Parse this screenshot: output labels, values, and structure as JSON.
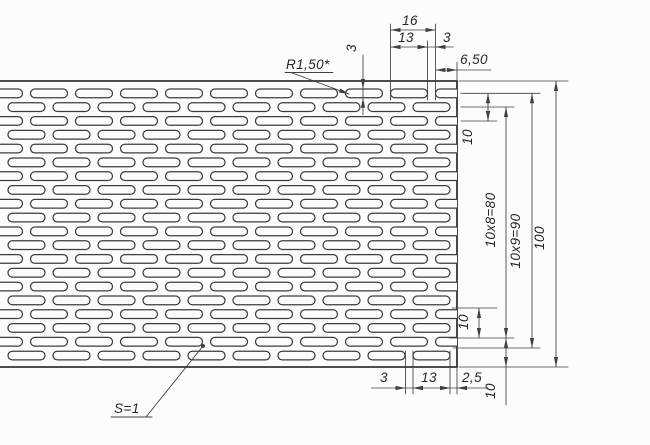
{
  "drawing": {
    "canvas": {
      "width": 650,
      "height": 445,
      "background": "#fcfcfc"
    },
    "colors": {
      "contour": "#343434",
      "slot": "#3d3d3d",
      "thin": "#404040",
      "text": "#262626"
    },
    "plate": {
      "top": 81,
      "bottom": 367,
      "right_edge": 457
    },
    "pattern": {
      "slot_length_px": 37,
      "slot_height_px": 8.7,
      "corner_radius_px": 4.35,
      "pitch_x_px": 45,
      "row_pitch_px": 13.8,
      "first_row_top_px": 89,
      "rows": 20,
      "a_row_start_px": 30.5,
      "b_row_start_px": 8,
      "a_m_from": -1,
      "a_m_to": 9,
      "b_m_from": 0,
      "b_m_to": 9
    },
    "dims_h": [
      {
        "id": "pitch-16",
        "label": "16",
        "y": 30,
        "x1": 390.5,
        "x2": 435.5,
        "arrows": "inside",
        "tx": 410,
        "ty": 25,
        "tail_left": 0,
        "tail_right": 0
      },
      {
        "id": "slot-13-top",
        "label": "13",
        "y": 47,
        "x1": 390.5,
        "x2": 427.5,
        "arrows": "inside",
        "tx": 406,
        "ty": 42,
        "tail_left": 0,
        "tail_right": 0
      },
      {
        "id": "gap-3-top",
        "label": "3",
        "y": 47,
        "x1": 427.5,
        "x2": 435.5,
        "arrows": "outside",
        "tx": 447,
        "ty": 42,
        "tail_left": 0,
        "tail_right": 18
      },
      {
        "id": "edge-slot-650",
        "label": "6,50",
        "y": 70,
        "x1": 435.5,
        "x2": 457,
        "arrows": "inside",
        "tx": 474,
        "ty": 64,
        "tail_left": 0,
        "tail_right": 34
      },
      {
        "id": "gap-3-bottom",
        "label": "3",
        "y": 388,
        "x1": 405.5,
        "x2": 413,
        "arrows": "outside",
        "tx": 384,
        "ty": 382,
        "tail_left": 34,
        "tail_right": 0
      },
      {
        "id": "slot-13-bottom",
        "label": "13",
        "y": 388,
        "x1": 413,
        "x2": 450,
        "arrows": "inside",
        "tx": 429,
        "ty": 382,
        "tail_left": 0,
        "tail_right": 0
      },
      {
        "id": "edge-margin-25",
        "label": "2,5",
        "y": 388,
        "x1": 450,
        "x2": 457,
        "arrows": "outside",
        "tx": 472,
        "ty": 382,
        "tail_left": 0,
        "tail_right": 31
      }
    ],
    "dims_v": [
      {
        "id": "slot-width-3",
        "label": "3",
        "x": 363,
        "y1": 89,
        "y2": 97.7,
        "arrows": "outside",
        "tx": 356,
        "ty": 48,
        "tail_top": 34,
        "tail_bottom": 17
      },
      {
        "id": "row-pitch-top",
        "label": "10",
        "x": 488,
        "y1": 93.3,
        "y2": 121,
        "arrows": "inside",
        "tx": 472,
        "ty": 137,
        "tail_top": 0,
        "tail_bottom": 0
      },
      {
        "id": "row-pitch-low",
        "label": "10",
        "x": 479,
        "y1": 308,
        "y2": 338,
        "arrows": "inside",
        "tx": 468,
        "ty": 322,
        "tail_top": 0,
        "tail_bottom": 0
      },
      {
        "id": "span-80",
        "label": "10x8=80",
        "x": 506,
        "y1": 107,
        "y2": 338,
        "arrows": "inside",
        "tx": 495,
        "ty": 220,
        "tail_top": 0,
        "tail_bottom": 0
      },
      {
        "id": "margin-10-bot",
        "label": "10",
        "x": 506,
        "y1": 338,
        "y2": 367,
        "arrows": "inside",
        "tx": 495,
        "ty": 391,
        "tail_top": 0,
        "tail_bottom": 38
      },
      {
        "id": "span-90",
        "label": "10x9=90",
        "x": 532,
        "y1": 93.3,
        "y2": 348,
        "arrows": "inside",
        "tx": 520,
        "ty": 241,
        "tail_top": 0,
        "tail_bottom": 0
      },
      {
        "id": "height-100",
        "label": "100",
        "x": 556,
        "y1": 81,
        "y2": 367,
        "arrows": "inside",
        "tx": 544,
        "ty": 238,
        "tail_top": 0,
        "tail_bottom": 0
      }
    ],
    "ext_h": [
      [
        459,
        81,
        568
      ],
      [
        461,
        93.3,
        540
      ],
      [
        461,
        121,
        497
      ],
      [
        461,
        107,
        514
      ],
      [
        452,
        308,
        497
      ],
      [
        449,
        338,
        514
      ],
      [
        453,
        348,
        540
      ],
      [
        459,
        367,
        568
      ]
    ],
    "ext_v": [
      [
        390.5,
        24,
        100
      ],
      [
        427.5,
        41,
        100
      ],
      [
        435.5,
        24,
        100
      ],
      [
        457,
        62,
        81
      ],
      [
        405.5,
        351,
        394
      ],
      [
        413,
        351,
        394
      ],
      [
        450,
        351,
        394
      ],
      [
        457,
        367,
        394
      ]
    ],
    "leaders": [
      {
        "id": "radius-note",
        "label": "R1,50*",
        "tx": 286,
        "ty": 69,
        "shelf": [
          285,
          72.5,
          333
        ],
        "line": [
          291,
          72.5,
          349,
          94
        ],
        "end": "arrow"
      },
      {
        "id": "thickness-note",
        "label": "S=1",
        "tx": 114,
        "ty": 413,
        "shelf": [
          111,
          417,
          152
        ],
        "line": [
          146,
          417,
          203,
          346
        ],
        "end": "dot"
      }
    ]
  }
}
